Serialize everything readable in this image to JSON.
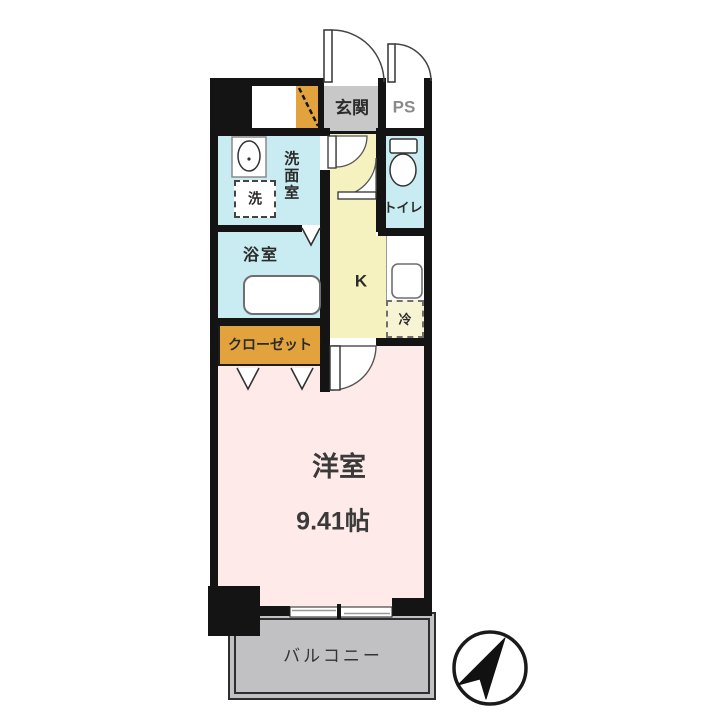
{
  "rooms": {
    "genkan": "玄関",
    "ps": "PS",
    "senmenshitsu": "洗面室",
    "washer": "洗",
    "toilet": "トイレ",
    "bath": "浴室",
    "kitchen": "K",
    "fridge": "冷",
    "closet": "クローゼット",
    "western_room": "洋室",
    "western_room_size": "9.41帖",
    "balcony": "バルコニー"
  },
  "icons": {
    "north_arrow": "north-arrow-icon",
    "bathtub": "bathtub-icon",
    "sink": "sink-icon",
    "toilet_bowl": "toilet-icon",
    "kitchen_sink": "kitchen-sink-icon"
  },
  "colors": {
    "wall": "#141414",
    "water_rooms": "#c9ecf2",
    "kitchen_floor": "#f6f2bf",
    "entrance_floor": "#c8c8c8",
    "entrance_step": "#e2a23e",
    "closet": "#e2a23e",
    "main_room": "#fdeae9",
    "balcony": "#c1c1c3",
    "fridge_space": "#f7f4d4"
  }
}
